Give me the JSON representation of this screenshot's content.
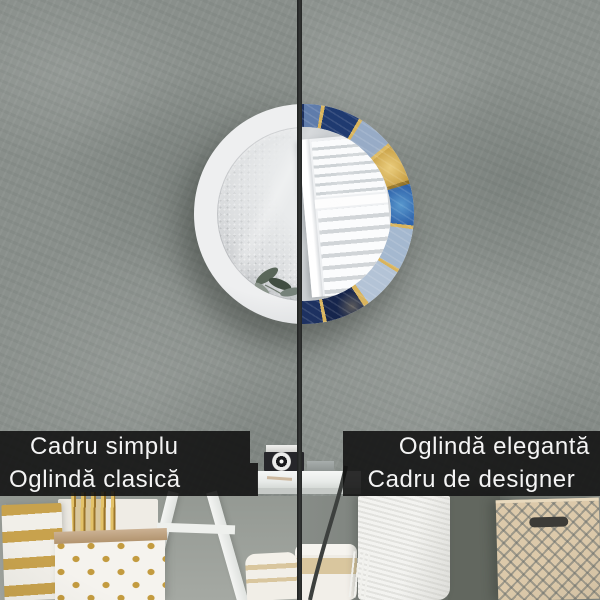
{
  "panel_labels": {
    "left_top": "Cadru simplu",
    "left_bottom": "Oglindă clasică",
    "right_top": "Oglindă elegantă",
    "right_bottom": "Cadru de designer"
  },
  "scene": {
    "objects": [
      "round-wall-mirror",
      "simple-white-frame",
      "designer-marble-gold-frame",
      "window-shutter-reflection",
      "plant-leaves-reflection",
      "textured-plaster-wall",
      "vintage-camera",
      "console-table",
      "gold-striped-paper-bag",
      "gold-polka-dot-paper-bag",
      "gold-reeds",
      "white-desk-legs",
      "striped-pillow",
      "knit-throw",
      "patterned-storage-basket",
      "chair-frame",
      "split-divider-line"
    ]
  },
  "colors": {
    "wall": "#8b918d",
    "divider": "#2a2c2b",
    "label_bar_background": "#101010",
    "label_text": "#f4f4f4",
    "simple_frame": "#e4e5e7",
    "mirror_glass": "#d9dbdd",
    "designer_navy": "#1f3a70",
    "designer_agate_blue": "#2f63ab",
    "designer_pale_marble": "#a4b8cf",
    "designer_gold": "#c59b3e",
    "gold_accent": "#c9a54a",
    "basket_beige": "#dcc9aa"
  }
}
